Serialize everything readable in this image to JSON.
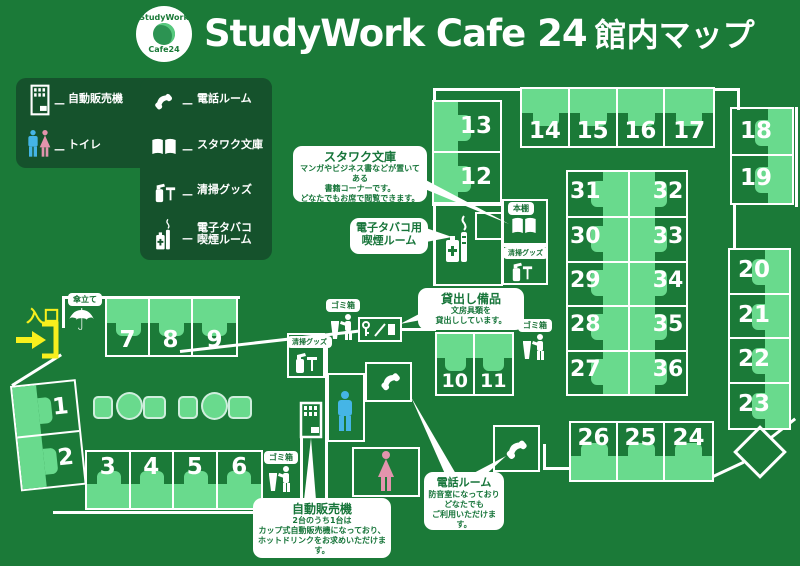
{
  "header": {
    "title_latin": "StudyWork Cafe 24",
    "title_jp": "館内マップ",
    "logo_top": "StudyWork",
    "logo_bottom": "Cafe24"
  },
  "legend": {
    "dash": "—",
    "items": [
      {
        "icon": "vending-machine-icon",
        "label": "自動販売機"
      },
      {
        "icon": "toilet-icon",
        "label": "トイレ"
      },
      {
        "icon": "phone-icon",
        "label": "電話ルーム"
      },
      {
        "icon": "book-icon",
        "label": "スタワク文庫"
      },
      {
        "icon": "cleaning-icon",
        "label": "清掃グッズ"
      },
      {
        "icon": "ecig-icon",
        "label": "電子タバコ\n喫煙ルーム"
      }
    ]
  },
  "entrance": {
    "label": "入口"
  },
  "pills": {
    "umbrella_stand": "傘立て",
    "trash": "ゴミ箱",
    "bookshelf": "本棚",
    "cleaning": "清掃グッズ"
  },
  "seats": {
    "g789": [
      "7",
      "8",
      "9"
    ],
    "g12": [
      "1",
      "2"
    ],
    "g36": [
      "3",
      "4",
      "5",
      "6"
    ],
    "g1011": [
      "10",
      "11"
    ],
    "g1312": [
      "13",
      "12"
    ],
    "g1417": [
      "14",
      "15",
      "16",
      "17"
    ],
    "g1819": [
      "18",
      "19"
    ],
    "g2023": [
      "20",
      "21",
      "22",
      "23"
    ],
    "g262524": [
      "26",
      "25",
      "24"
    ],
    "desk_left": [
      "31",
      "30",
      "29",
      "28",
      "27"
    ],
    "desk_right": [
      "32",
      "33",
      "34",
      "35",
      "36"
    ]
  },
  "callouts": {
    "bunko": {
      "title": "スタワク文庫",
      "body": [
        "マンガやビジネス書などが置いてある",
        "書籍コーナーです。",
        "どなたでもお席で閲覧できます。"
      ]
    },
    "smoking": {
      "title": "電子タバコ用\n喫煙ルーム"
    },
    "lending": {
      "title": "貸出し備品",
      "body": [
        "文房具類を",
        "貸出ししています。"
      ]
    },
    "phone": {
      "title": "電話ルーム",
      "body": [
        "防音室になっており",
        "どなたでも",
        "ご利用いただけます。"
      ]
    },
    "vending": {
      "title": "自動販売機",
      "body": [
        "2台のうち1台は",
        "カップ式自動販売機になっており、",
        "ホットドリンクをお求めいただけます。"
      ]
    }
  },
  "colors": {
    "background_green": "#1b7a38",
    "legend_dark_green": "#15522c",
    "furniture_light_green": "#69da8d",
    "wall_white": "#ffffff",
    "entrance_yellow": "#f8ef1d",
    "toilet_male_blue": "#45b5e6",
    "toilet_female_pink": "#e294ad",
    "callout_text_green": "#17753a"
  }
}
